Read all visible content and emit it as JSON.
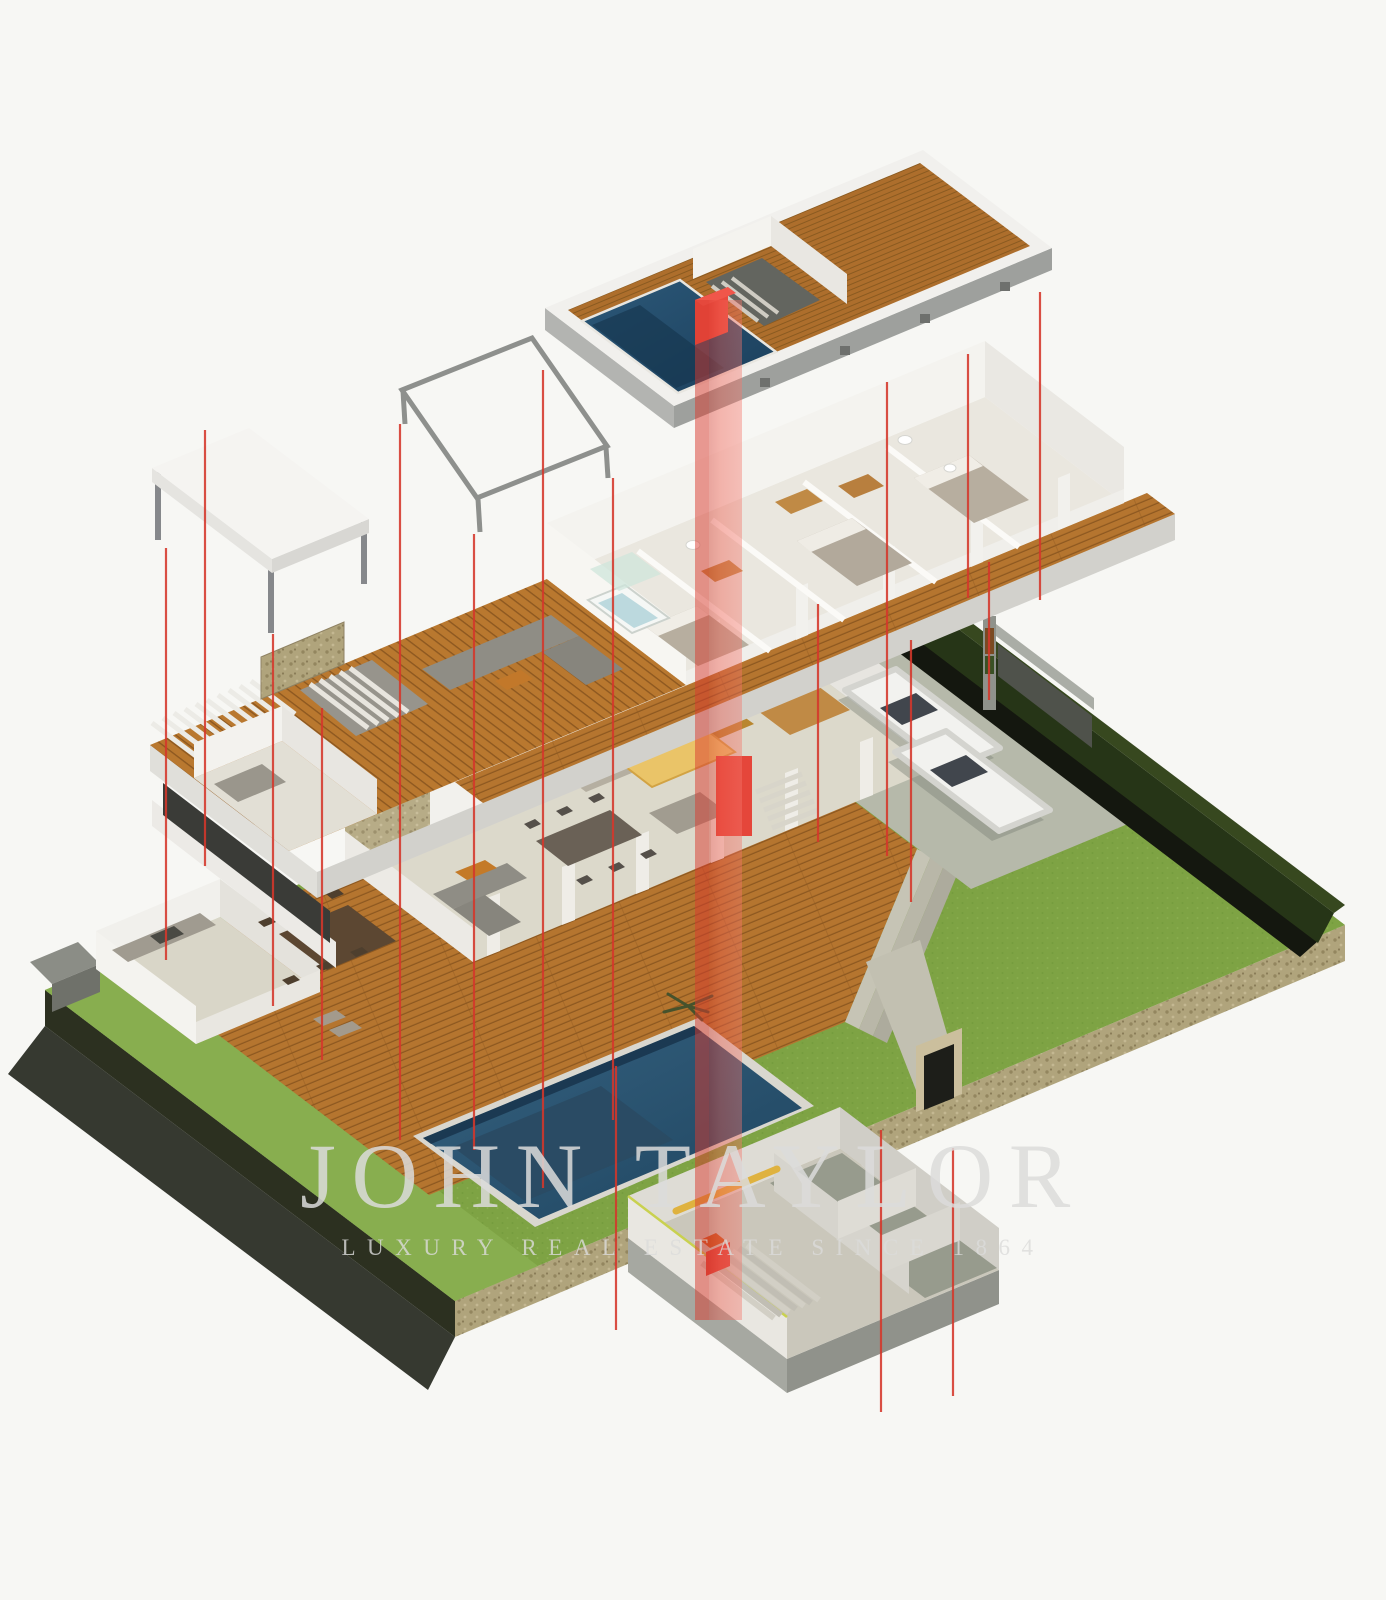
{
  "watermark": {
    "brand": "JOHN TAYLOR",
    "tagline": "LUXURY REAL ESTATE SINCE 1864"
  },
  "colors": {
    "background": "#f7f7f4",
    "watermark": "#dcdcdb",
    "wood-deck": "#b5752f",
    "wood-gap": "#8d5820",
    "wood-ff": "#b9782f",
    "wood-roof": "#ad6e2c",
    "grass": "#7ea344",
    "grass-strip": "#88ae4f",
    "hedge": "#263517",
    "hedge-shadow": "#14170f",
    "gravel": "#b0a47c",
    "concrete": "#b6b9aa",
    "stone-floor": "#dcd9cb",
    "wall-white": "#f2f1ed",
    "wall-shade": "#e7e5e0",
    "slab-gray": "#9ea09d",
    "pool-dark": "#1f4560",
    "pool-light": "#35617f",
    "lounger-blue": "#2a4a63",
    "red-line": "#d5372b",
    "red-shaft": "#f05a4c",
    "red-solid": "#e5463a",
    "car-body": "#f2f2ef",
    "tan-wood": "#c08a45",
    "canopy-tan": "#eac468",
    "soil-dark": "#2c3020",
    "shadow-dark": "#20231b"
  }
}
